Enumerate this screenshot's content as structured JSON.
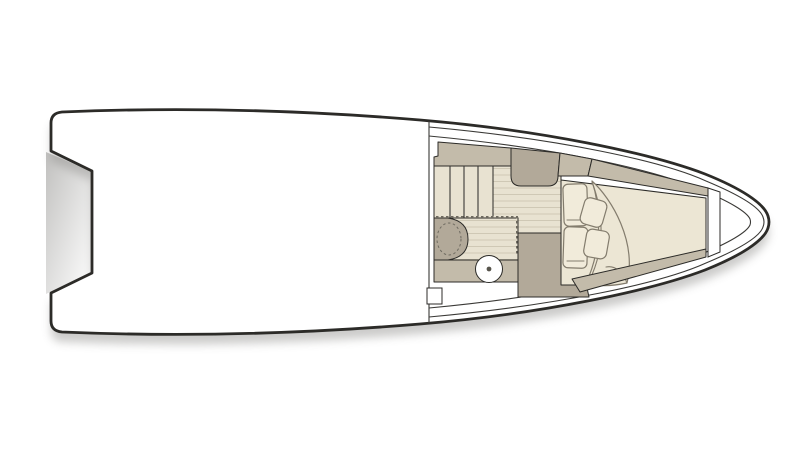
{
  "page": {
    "background": "#ffffff",
    "alt": "Top-view floor plan of a motor boat: open white cockpit aft with stepped transom platform, forward cabin with companionway steps, galley module, wet head with washbasin and toilet behind a dashed sliding enclosure, and a V-berth double bed with two pillows, two cushions and a folded duvet in the bow."
  },
  "colors": {
    "hull_white": "#ffffff",
    "outline": "#2c2b28",
    "line_thin": "#3a3936",
    "furniture_tan": "#c3bbaa",
    "furniture_tan_dark": "#b2a999",
    "floor_beige": "#e8e2d1",
    "floor_plank": "#cfc8b5",
    "bed_cream": "#ece6d4",
    "pillow_cream": "#f1ebda",
    "bed_outline": "#837c6d",
    "dashed_door": "#6e6a60",
    "shadow": "#8e8d8a",
    "toilet_dot": "#57544c"
  },
  "parts": {
    "boat": "Motor boat floor plan (top view, bow to the right)",
    "hull": "Hull outline",
    "swim_platform": "Stern transom recess / swim platform",
    "gunwale": "Gunwale and rub-rail lines",
    "cockpit": "Open cockpit deck",
    "bulkhead": "Cockpit-to-cabin bulkhead",
    "steps": "Companionway steps",
    "cabin_sole": "Cabin sole (planked walkway)",
    "galley": "Galley module",
    "side_cabinet": "Port side cabinet",
    "side_cabinet_fwd": "Forward side cabinet",
    "head": "Head compartment floor",
    "washbasin": "Washbasin unit",
    "counter": "Vanity counter",
    "toilet": "Toilet",
    "door": "Head enclosure sliding door (dashed)",
    "bench": "Step bench at berth foot",
    "berth": "V-berth double bed",
    "duvet": "Folded duvet",
    "pillow_port": "Pillow (port)",
    "pillow_starboard": "Pillow (starboard)",
    "cushion_1": "Loose cushion",
    "cushion_2": "Loose cushion",
    "shelf_port": "Port side shelf along berth",
    "shelf_starboard": "Starboard side shelf along berth",
    "bow_bulkhead": "Bow anchor-locker bulkhead",
    "shadow": "Drop shadow under hull"
  }
}
